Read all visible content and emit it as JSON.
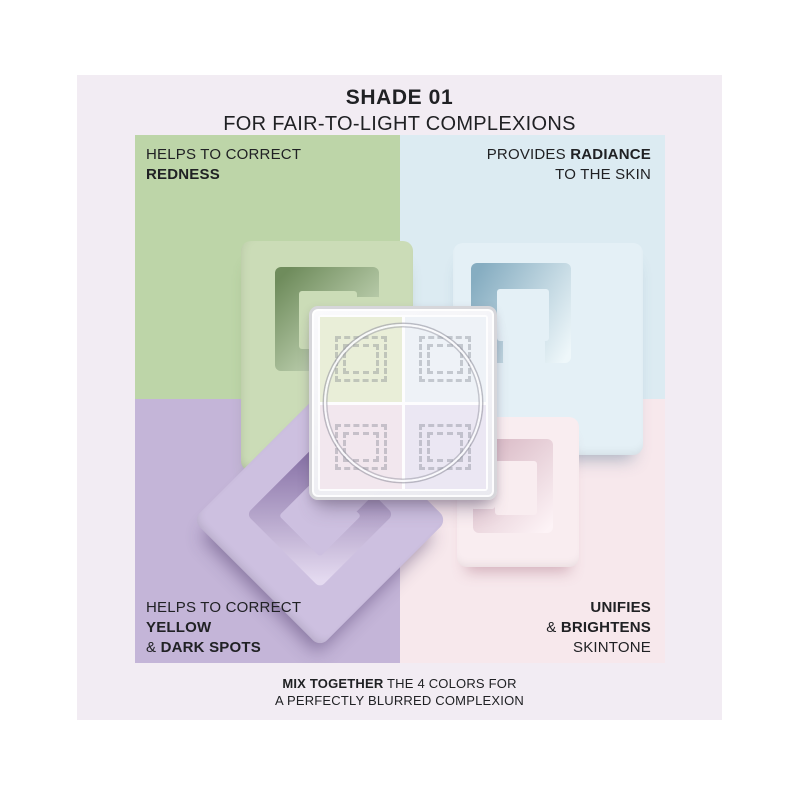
{
  "header": {
    "title": "SHADE 01",
    "subtitle": "FOR FAIR-TO-LIGHT COMPLEXIONS"
  },
  "quadrants": {
    "top_left": {
      "color_name": "green",
      "swatch": "#bdd5a8",
      "label": {
        "line1": "HELPS TO CORRECT",
        "line2_bold": "REDNESS"
      }
    },
    "top_right": {
      "color_name": "blue",
      "swatch": "#dcebf2",
      "label": {
        "line1_regular": "PROVIDES ",
        "line1_bold": "RADIANCE",
        "line2": "TO THE SKIN"
      }
    },
    "bottom_left": {
      "color_name": "purple",
      "swatch": "#c4b5d8",
      "label": {
        "line1": "HELPS TO CORRECT",
        "line2_bold": "YELLOW",
        "line3_amp": "& ",
        "line3_bold": "DARK SPOTS"
      }
    },
    "bottom_right": {
      "color_name": "pink",
      "swatch": "#f7e8ec",
      "label": {
        "line1_bold": "UNIFIES",
        "line2_amp": "& ",
        "line2_bold": "BRIGHTENS",
        "line3": "SKINTONE"
      }
    }
  },
  "caption": {
    "bold": "MIX TOGETHER",
    "rest": " THE 4 COLORS FOR",
    "line2": "A PERFECTLY BLURRED COMPLEXION"
  },
  "colors": {
    "page_bg": "#ffffff",
    "panel_bg": "#f2ecf3",
    "text": "#202124",
    "green_base": "#bdd5a8",
    "green_face": "#cbdcb7",
    "green_deep": "#6f8c5c",
    "green_lit": "#dcead0",
    "blue_base": "#dcebf2",
    "blue_face": "#e4f0f6",
    "blue_deep": "#86adc1",
    "blue_lit": "#eef7fa",
    "purple_base": "#c4b5d8",
    "purple_face": "#cdc0e0",
    "purple_deep": "#8771a6",
    "purple_lit": "#e4daf0",
    "pink_base": "#f7e8ec",
    "pink_face": "#f9edf0",
    "pink_deep": "#d8b8c4",
    "pink_lit": "#fdf3f6",
    "compact_frame": "#d6d6da",
    "compact_pane_tl": "#e9eed8",
    "compact_pane_tr": "#eef2f7",
    "compact_pane_bl": "#f2e7ee",
    "compact_pane_br": "#ebe7f3"
  }
}
